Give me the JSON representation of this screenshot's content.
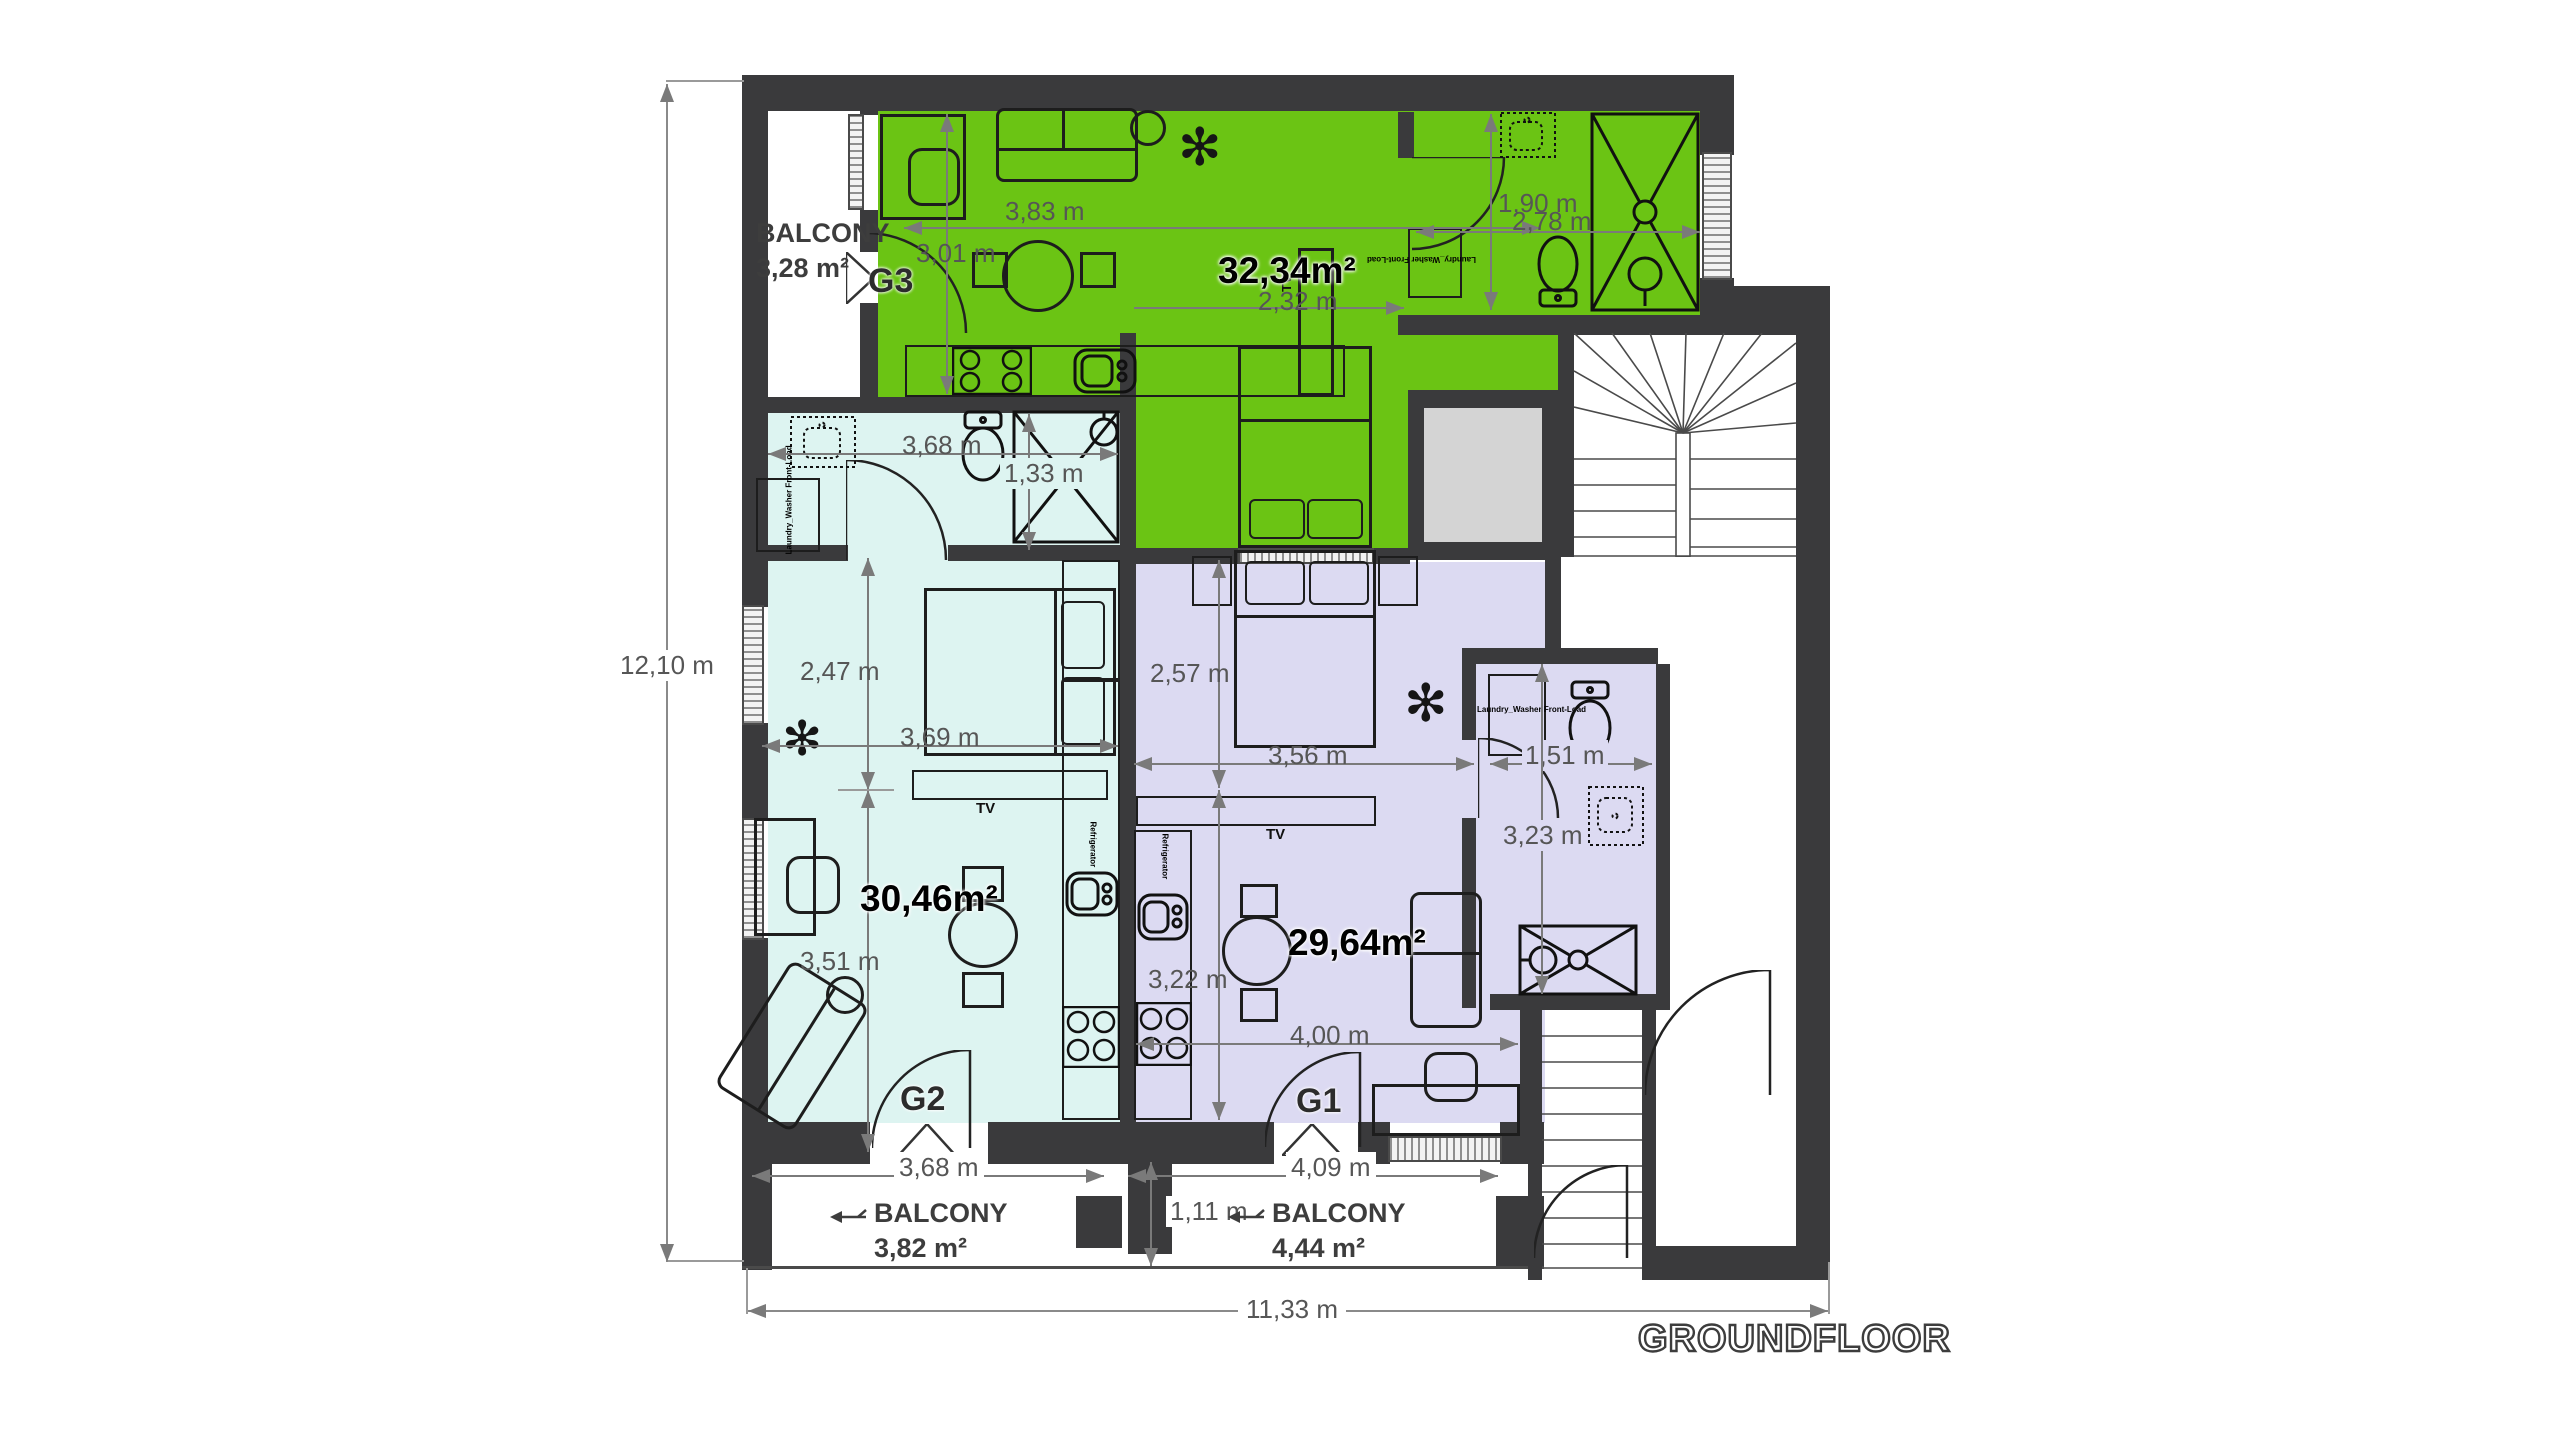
{
  "title": "GROUNDFLOOR",
  "colors": {
    "wall": "#3a3a3c",
    "apartment_g3": "#6bc414",
    "apartment_g2": "#ddf4f1",
    "apartment_g1": "#dcdaf2",
    "shaft": "#d4d4d4",
    "dimension": "#565656"
  },
  "apartments": {
    "g3": {
      "id": "G3",
      "area": "32,34m²"
    },
    "g2": {
      "id": "G2",
      "area": "30,46m²"
    },
    "g1": {
      "id": "G1",
      "area": "29,64m²"
    }
  },
  "balconies": {
    "top": {
      "label": "BALCONY",
      "area": "3,28 m²"
    },
    "g2": {
      "label": "BALCONY",
      "area": "3,82 m²"
    },
    "g1": {
      "label": "BALCONY",
      "area": "4,44 m²"
    }
  },
  "dimensions": {
    "living_g3_w": "3,83 m",
    "living_g3_h": "3,01 m",
    "hall_g3": "2,32 m",
    "bath_g3_h": "1,90 m",
    "bath_g3_w": "2,78 m",
    "bath_g2_w": "3,68 m",
    "bath_g2_h": "1,33 m",
    "bed_g2_h": "2,47 m",
    "living_g2_w": "3,69 m",
    "living_g2_h": "3,51 m",
    "bed_g1_h": "2,57 m",
    "bed_g1_w": "3,56 m",
    "bath_g1_w": "1,51 m",
    "bath_g1_h": "3,23 m",
    "living_g1_h": "3,22 m",
    "living_g1_w": "4,00 m",
    "balcony_g2_w": "3,68 m",
    "balcony_g1_w": "4,09 m",
    "balcony_depth": "1,11 m",
    "total_height": "12,10 m",
    "total_width": "11,33 m"
  },
  "labels": {
    "tv": "TV",
    "refrigerator": "Refrigerator",
    "washer": "Laundry_Washer Front-Load"
  }
}
